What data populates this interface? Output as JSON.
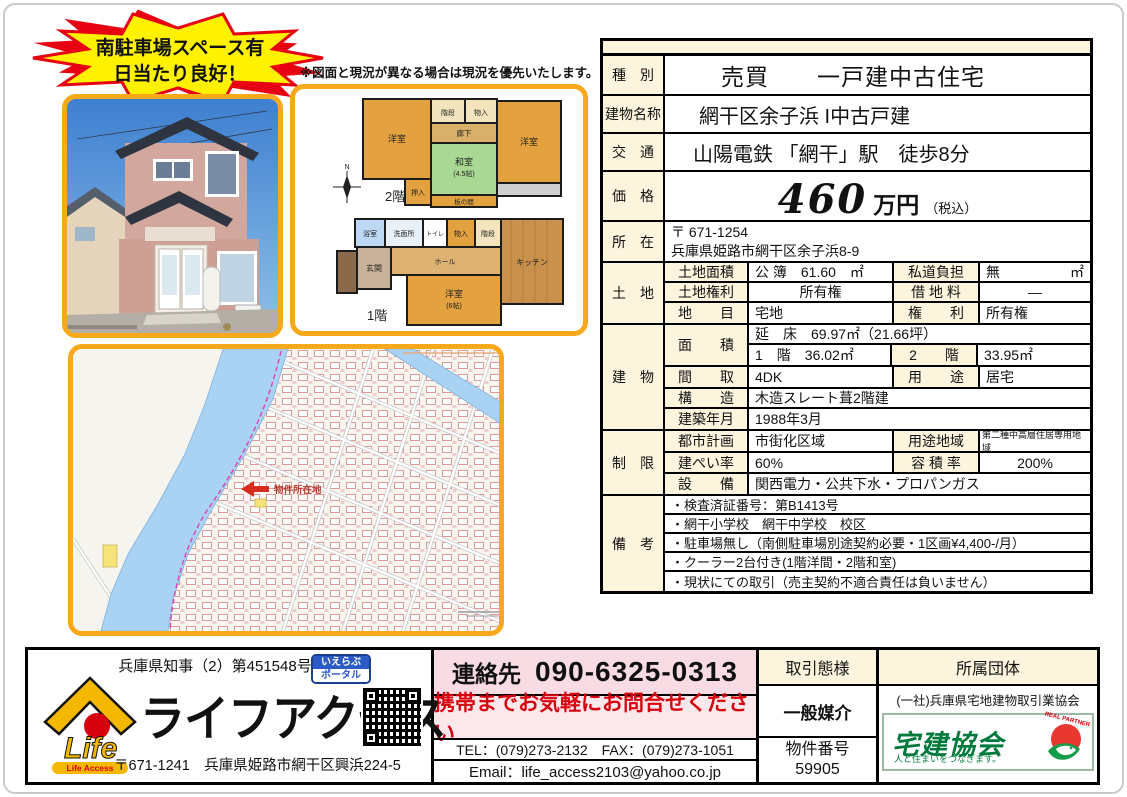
{
  "colors": {
    "accent_border_yellow": "#F7A81B",
    "table_label_cream": "#FCF4DD",
    "contact_pink": "#F9DCE3",
    "alert_red": "#D7000F",
    "takken_green": "#00793C",
    "map_river_blue": "#AAD2F2",
    "star_yellow": "#FFF100",
    "star_red": "#E60012"
  },
  "badge": {
    "line1": "南駐車場スペース有",
    "line2": "日当たり良好！"
  },
  "floorplan": {
    "note": "※図面と現況が異なる場合は現況を優先いたします。",
    "floor2_label": "2階",
    "floor1_label": "1階",
    "compass": "N",
    "f2": {
      "room_w1": "洋室",
      "stairs": "階段",
      "storage": "物入",
      "hall": "廊下",
      "washitsu": "和室",
      "washitsu_size": "(4.5帖)",
      "room_w2": "洋室",
      "oshiire": "押入",
      "itanoma": "板の間"
    },
    "f1": {
      "bath": "浴室",
      "washroom": "洗面所",
      "toilet": "トイレ",
      "storage": "物入",
      "stairs": "階段",
      "kitchen": "キッチン",
      "genkan": "玄関",
      "hall": "ホール",
      "room_w": "洋室",
      "room_w_size": "(6帖)"
    }
  },
  "map": {
    "marker": "物件所在地"
  },
  "table": {
    "type_label": "種　別",
    "type_value": "売買　　一戸建中古住宅",
    "name_label": "建物名称",
    "name_value": "網干区余子浜 I中古戸建",
    "access_label": "交　通",
    "access_value": "山陽電鉄 「網干」駅　徒歩8分",
    "price_label": "価　格",
    "price_number": "460",
    "price_unit": "万円",
    "price_tax": "（税込）",
    "addr_label": "所　在",
    "addr_line1": "〒 671-1254",
    "addr_line2": "兵庫県姫路市網干区余子浜8-9",
    "land_label": "土　地",
    "land_rows": [
      {
        "k1": "土地面積",
        "v1": "公 簿　61.60　㎡",
        "k2": "私道負担",
        "v2": "無",
        "v2u": "㎡"
      },
      {
        "k1": "土地権利",
        "v1": "所有権",
        "k2": "借 地 料",
        "v2": "―",
        "v2u": ""
      },
      {
        "k1": "地　　目",
        "v1": "宅地",
        "k2": "権　　利",
        "v2": "所有権",
        "v2u": ""
      }
    ],
    "bldg_label": "建　物",
    "bldg": {
      "area_key": "面　　積",
      "total_floor": "延　床　69.97㎡（21.66坪）",
      "f1": "1　階　36.02㎡",
      "f2_key": "2　　階",
      "f2": "33.95㎡",
      "layout_key": "間　　取",
      "layout": "4DK",
      "use_key": "用　　途",
      "use": "居宅",
      "structure_key": "構　　造",
      "structure": "木造スレート葺2階建",
      "built_key": "建築年月",
      "built": "1988年3月"
    },
    "limit_label": "制　限",
    "limit": {
      "city_key": "都市計画",
      "city": "市街化区域",
      "zone_key": "用途地域",
      "zone": "第二種中高層住居専用地域",
      "bcr_key": "建ぺい率",
      "bcr": "60%",
      "far_key": "容 積 率",
      "far": "200%",
      "util_key": "設　　備",
      "util": "関西電力・公共下水・プロパンガス"
    },
    "remarks_label": "備　考",
    "remarks": [
      "・検査済証番号：第B1413号",
      "・網干小学校　網干中学校　校区",
      "・駐車場無し（南側駐車場別途契約必要・1区画¥4,400-/月）",
      "・クーラー2台付き(1階洋間・2階和室)",
      "・現状にての取引（売主契約不適合責任は負いません）"
    ]
  },
  "footer": {
    "license": "兵庫県知事（2）第451548号",
    "logo_life": "Life",
    "logo_sub": "Life Access",
    "company": "ライフアクセス",
    "address": "〒671-1241　兵庫県姫路市網干区興浜224-5",
    "portal_top": "いえらぶ",
    "portal_bottom": "ポータル",
    "contact_label": "連絡先",
    "phone": "090-6325-0313",
    "contact_note": "携帯までお気軽にお問合せください",
    "telfax": "TEL：(079)273-2132　FAX：(079)273-1051",
    "email": "Email：life_access2103@yahoo.co.jp",
    "dealtype_header": "取引態様",
    "dealtype": "一般媒介",
    "property_no_label": "物件番号",
    "property_no": "59905",
    "org_header": "所属団体",
    "org_name": "(一社)兵庫県宅地建物取引業協会",
    "takken_name": "宅建協会",
    "takken_tagline": "人と住まいをつなぎます。",
    "real_partner": "REAL PARTNER"
  }
}
